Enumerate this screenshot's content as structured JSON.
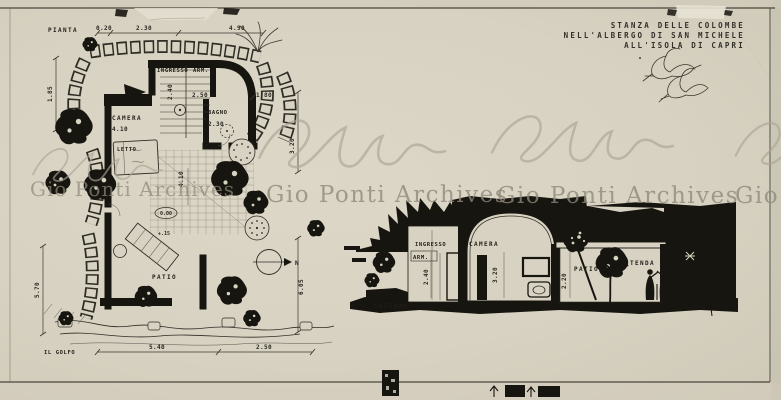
{
  "artwork": {
    "kind": "scanned architectural drawing (plan and section)",
    "title_block": {
      "line1": "STANZA DELLE COLOMBE",
      "line2": "NELL'ALBERGO DI SAN MICHELE",
      "line3": "ALL'ISOLA DI CAPRI"
    }
  },
  "plan": {
    "label": "PIANTA",
    "top_dims": [
      "0.20",
      "2.30",
      "4.90"
    ],
    "left_dims": {
      "upper": "1.85",
      "lower": "5.70"
    },
    "right_dims": {
      "upper": "3.20",
      "lower": "6.05"
    },
    "bottom_dims": [
      "5.40",
      "2.50"
    ],
    "coast_label": "IL GOLFO",
    "north_label": "N",
    "rooms": {
      "ingresso": "INGRESSO",
      "arm": "ARM.",
      "bagno": "BAGNO",
      "camera": "CAMERA",
      "letto": "LETTO",
      "patio": "PATIO"
    },
    "inner_dims": {
      "arm_width": "2.50",
      "door": "1.80",
      "bagno_width": "2.30",
      "camera_width": "4.10",
      "stair": "2.40",
      "patio_depth": "4.10"
    },
    "levels": {
      "zero": "0.00",
      "step": "+.15"
    }
  },
  "section": {
    "label": "SEZIONE",
    "rooms": {
      "ingresso": "INGRESSO",
      "arm": "ARM.",
      "camera": "CAMERA",
      "patio": "PATIO",
      "tenda": "TENDA"
    },
    "heights": {
      "ingresso": "2.40",
      "camera": "3.20",
      "patio": "2.20"
    }
  },
  "watermark": {
    "text": "Gio Ponti Archives"
  },
  "colors": {
    "paper": "#d8d2c2",
    "ink": "#17150f",
    "watermark_gray": "#8e897a"
  }
}
